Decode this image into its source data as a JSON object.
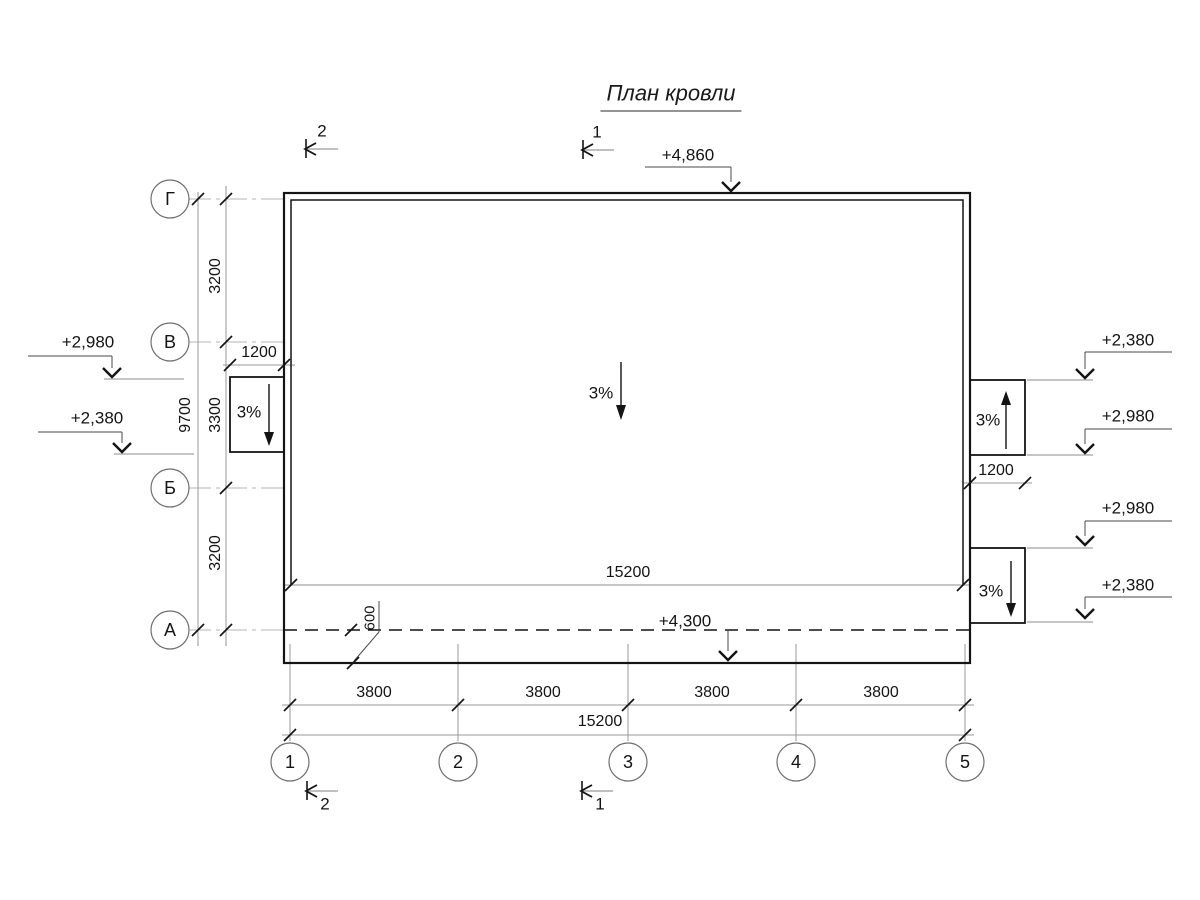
{
  "title": "План кровли",
  "row_axes": [
    "Г",
    "В",
    "Б",
    "А"
  ],
  "col_axes": [
    "1",
    "2",
    "3",
    "4",
    "5"
  ],
  "dims": {
    "total_height": "9700",
    "row_spans": [
      "3200",
      "3300",
      "3200"
    ],
    "bays": [
      "3800",
      "3800",
      "3800",
      "3800"
    ],
    "total_width": "15200",
    "roof_width": "15200",
    "chute_left_width": "1200",
    "chute_right_width": "1200",
    "eave_overhang": "600"
  },
  "elevations": {
    "roof_top": "+4,860",
    "eave": "+4,300",
    "left_upper": "+2,980",
    "left_lower": "+2,380",
    "right_1": "+2,380",
    "right_2": "+2,980",
    "right_3": "+2,980",
    "right_4": "+2,380"
  },
  "slopes": {
    "main": "3%",
    "left_chute": "3%",
    "right_upper_chute": "3%",
    "right_lower_chute": "3%"
  },
  "section_marks": {
    "section_1": "1",
    "section_2": "2"
  },
  "line_colors": {
    "drawing": "#141414",
    "dimension": "#9a9a9a",
    "axis": "#b5b5b5"
  }
}
